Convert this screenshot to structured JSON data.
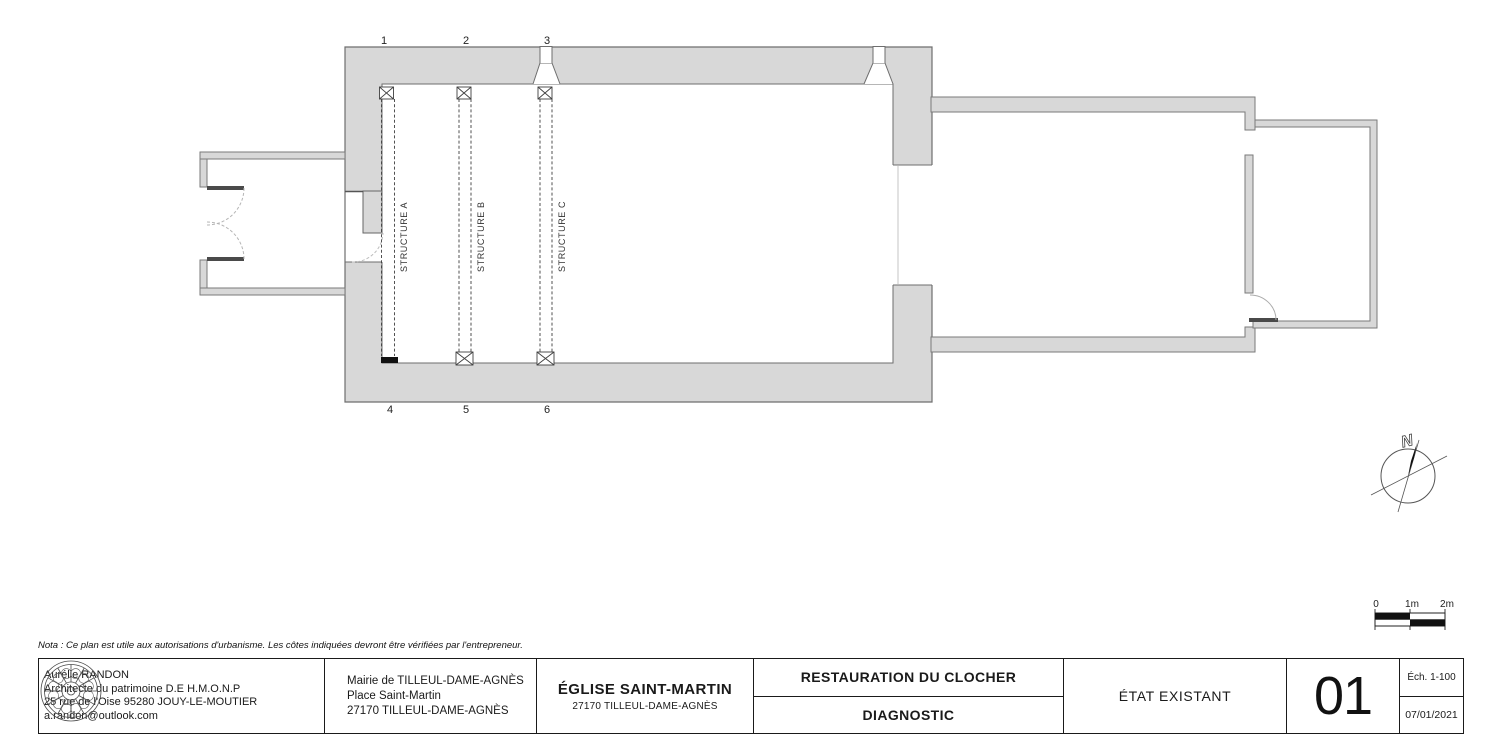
{
  "plan": {
    "grid_labels_top": [
      "1",
      "2",
      "3"
    ],
    "grid_labels_bottom": [
      "4",
      "5",
      "6"
    ],
    "structure_labels": [
      "STRUCTURE A",
      "STRUCTURE B",
      "STRUCTURE C"
    ],
    "north_label": "N",
    "scale_labels": [
      "0",
      "1m",
      "2m"
    ]
  },
  "nota": "Nota : Ce plan est utile aux autorisations d'urbanisme. Les côtes indiquées devront être vérifiées par l'entrepreneur.",
  "title_block": {
    "architect_lines": [
      "Aurélie RANDON",
      "Architecte du patrimoine D.E  H.M.O.N.P",
      "25 rue de l'Oise 95280 JOUY-LE-MOUTIER",
      "a.randon@outlook.com"
    ],
    "client_lines": [
      "Mairie de TILLEUL-DAME-AGNÈS",
      "Place Saint-Martin",
      "27170 TILLEUL-DAME-AGNÈS"
    ],
    "project_title": "ÉGLISE SAINT-MARTIN",
    "project_subtitle": "27170 TILLEUL-DAME-AGNÈS",
    "phase_title": "RESTAURATION DU CLOCHER",
    "phase_subtitle": "DIAGNOSTIC",
    "drawing_title": "ÉTAT EXISTANT",
    "sheet_number": "01",
    "scale": "Éch. 1-100",
    "date": "07/01/2021"
  },
  "colors": {
    "wall_fill": "#d8d8d8",
    "wall_outline": "#6e6e6e",
    "thin_wall_outline": "#7a7a7a",
    "ink": "#1a1a1a"
  }
}
